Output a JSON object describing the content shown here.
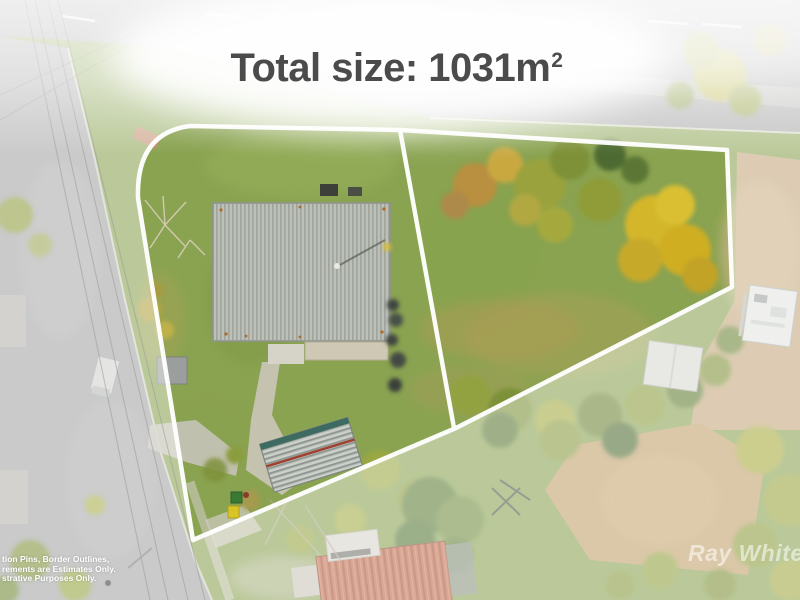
{
  "title": {
    "text": "Total size: 1031m",
    "superscript": "2",
    "color": "#4b4b4b"
  },
  "disclaimer": {
    "lines": [
      "tion Pins, Border Outlines,",
      "rements are Estimates Only.",
      "strative Purposes Only."
    ],
    "color": "#ffffff"
  },
  "watermark": {
    "brand": "Ray White",
    "style": "semi-transparent white italic"
  },
  "property": {
    "total_size": "1031m²",
    "lot_count": 2,
    "boundary_color": "#ffffff",
    "view": "aerial drone photo, two outlined lots on a corner block with house"
  },
  "palette": {
    "grass": "#8aa351",
    "road": "#a2a4a2",
    "dirt": "#c2a474",
    "house_roof": "#b6b9b2",
    "red_roof": "#bd6848",
    "autumn_tree": "#d4b62a"
  }
}
